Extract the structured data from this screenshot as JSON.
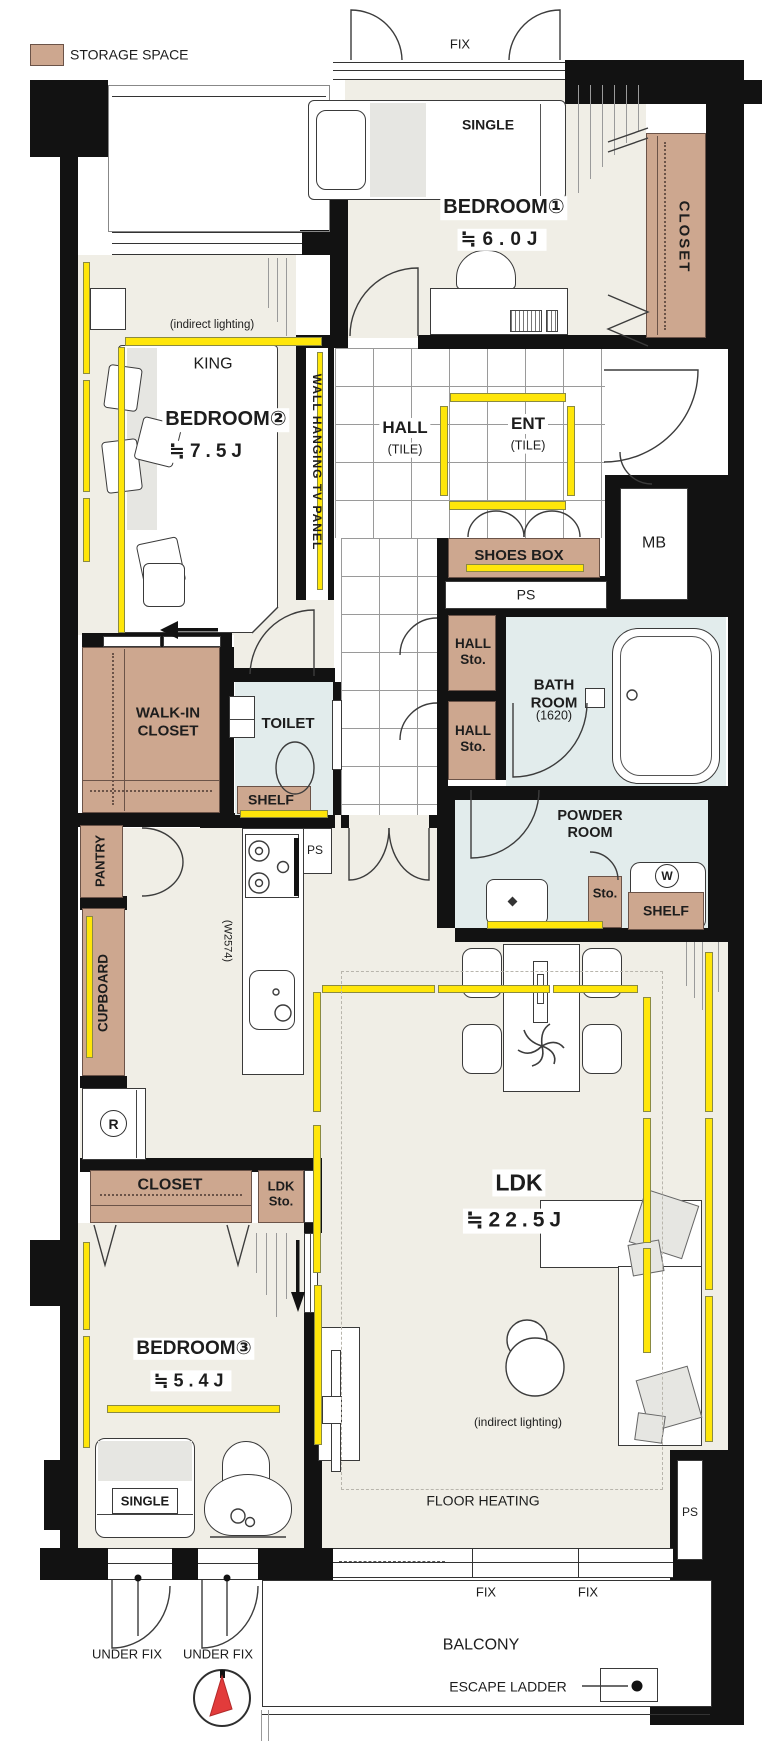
{
  "legend": {
    "storage_label": "STORAGE SPACE"
  },
  "colors": {
    "storage": "#CDA78F",
    "lighting_strip": "#FFE60A",
    "wet_area": "#E2ECEC",
    "floor": "#F0EEE6",
    "wall": "#121212",
    "compass_needle": "#E23B3B"
  },
  "labels": {
    "fix_top": "FIX",
    "single1": "SINGLE",
    "bedroom1": "BEDROOM①",
    "bedroom1_size": "≒6.0J",
    "closet1": "CLOSET",
    "indirect2": "(indirect lighting)",
    "king": "KING",
    "bedroom2": "BEDROOM②",
    "bedroom2_size": "≒7.5J",
    "tv_panel": "WALL HANGING TV PANEL",
    "hall": "HALL",
    "hall_tile": "(TILE)",
    "ent": "ENT",
    "ent_tile": "(TILE)",
    "shoes_box": "SHOES BOX",
    "ps_ent": "PS",
    "mb": "MB",
    "hall_sto1": "HALL\nSto.",
    "hall_sto2": "HALL\nSto.",
    "bath_name": "BATH\nROOM",
    "bath_size": "(1620)",
    "wic": "WALK-IN\nCLOSET",
    "toilet": "TOILET",
    "shelf_toilet": "SHELF",
    "powder": "POWDER\nROOM",
    "sto_powder": "Sto.",
    "shelf_powder": "SHELF",
    "washer": "W",
    "pantry": "PANTRY",
    "w2574": "(W2574)",
    "cupboard": "CUPBOARD",
    "ps_mid": "PS",
    "fridge": "R",
    "closet3": "CLOSET",
    "ldk_sto": "LDK\nSto.",
    "ldk": "LDK",
    "ldk_size": "≒22.5J",
    "bedroom3": "BEDROOM③",
    "bedroom3_size": "≒5.4J",
    "single3": "SINGLE",
    "indirect_ldk": "(indirect lighting)",
    "floor_heating": "FLOOR HEATING",
    "ps_br": "PS",
    "fix_b1": "FIX",
    "fix_b2": "FIX",
    "balcony": "BALCONY",
    "escape": "ESCAPE LADDER",
    "under_fix1": "UNDER FIX",
    "under_fix2": "UNDER FIX"
  }
}
